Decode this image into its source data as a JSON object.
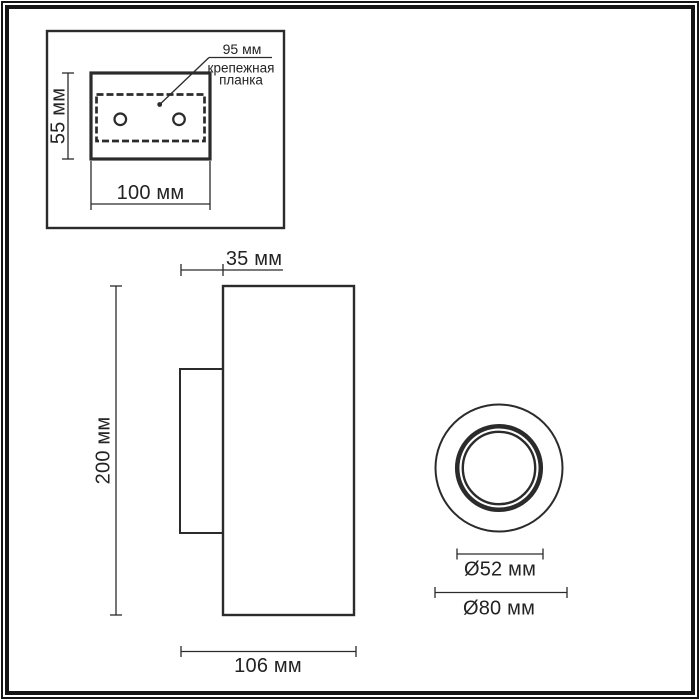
{
  "colors": {
    "line": "#2b2b2b",
    "text": "#232323",
    "frame": "#141414",
    "background": "#ffffff"
  },
  "inset": {
    "plate_span_label": "95 мм",
    "plate_name_line1": "крепежная",
    "plate_name_line2": "планка",
    "plate_height_label": "55 мм",
    "plate_width_label": "100 мм"
  },
  "side_view": {
    "top_depth_label": "35 мм",
    "height_label": "200 мм",
    "total_depth_label": "106 мм"
  },
  "front_view": {
    "inner_diameter_label": "Ø52 мм",
    "outer_diameter_label": "Ø80 мм"
  }
}
